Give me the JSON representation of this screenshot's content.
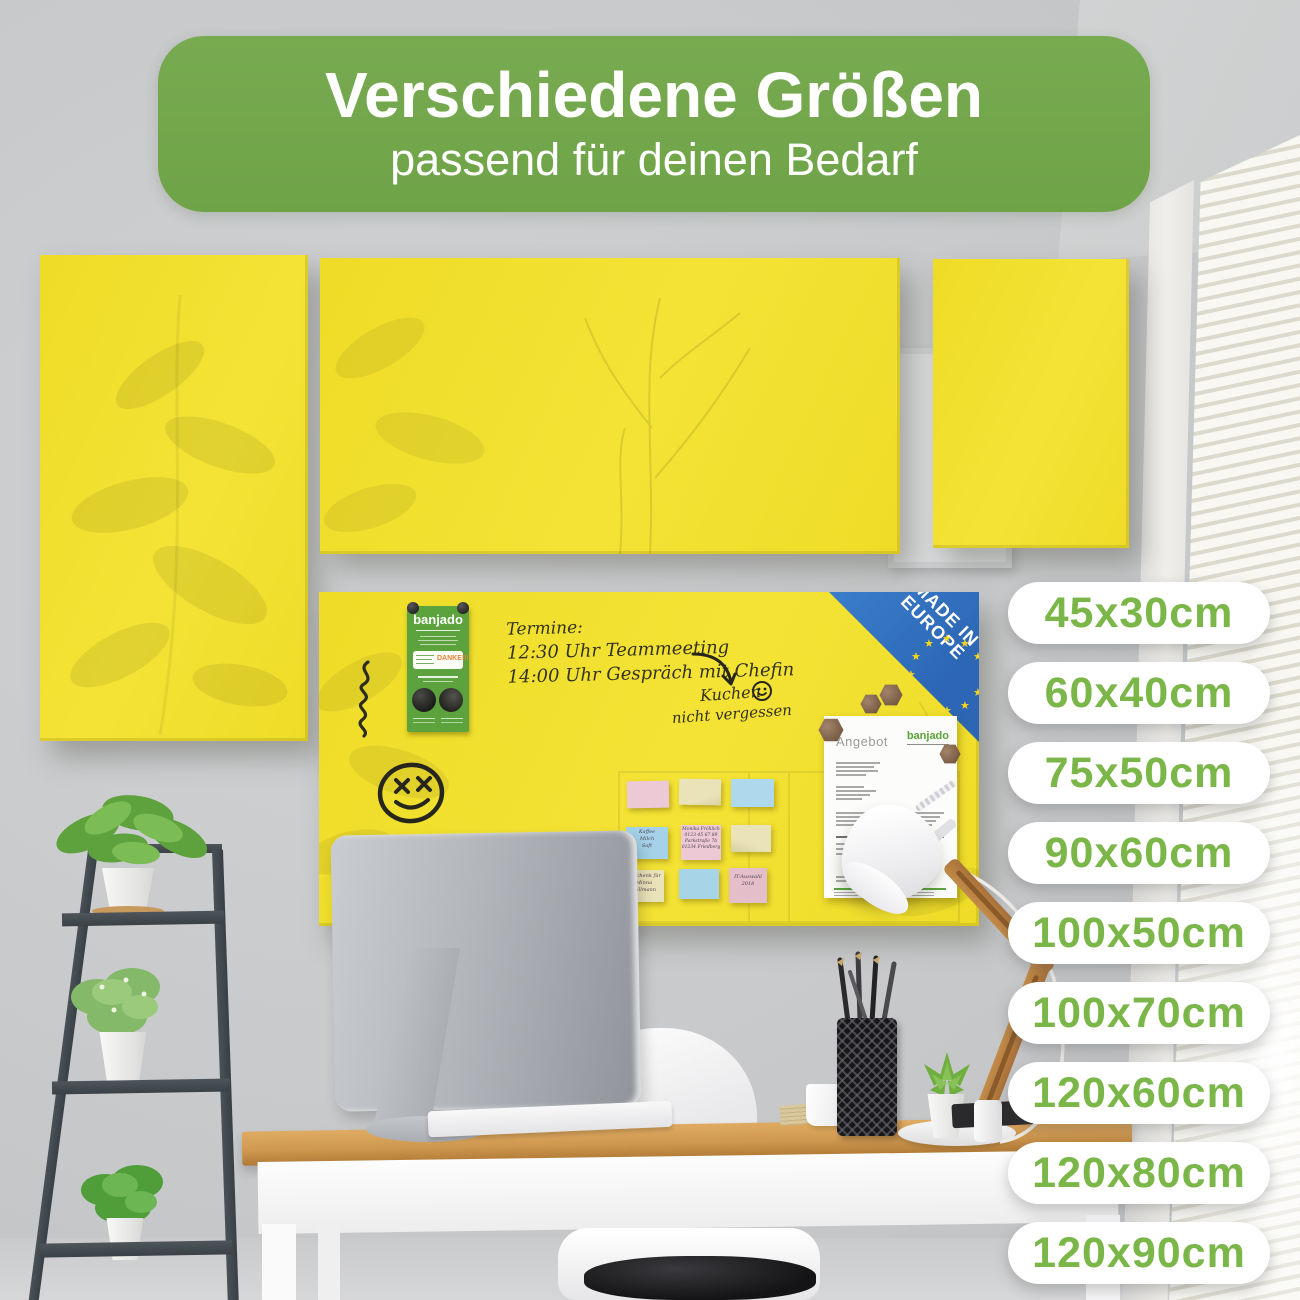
{
  "banner": {
    "title": "Verschiedene Größen",
    "subtitle": "passend für deinen Bedarf"
  },
  "sizes": [
    "45x30cm",
    "60x40cm",
    "75x50cm",
    "90x60cm",
    "100x50cm",
    "100x70cm",
    "120x60cm",
    "120x80cm",
    "120x90cm"
  ],
  "board": {
    "termine_lines": [
      "Termine:",
      "12:30 Uhr Teammeeting",
      "14:00 Uhr Gespräch mit Chefin"
    ],
    "kuchen_lines": [
      "Kuchen",
      "nicht vergessen"
    ],
    "made_in": {
      "line1": "MADE IN",
      "line2": "EUROPE"
    },
    "flyer": {
      "brand": "banjado",
      "danke": "DANKE!!!"
    },
    "document": {
      "title": "Angebot",
      "brand": "banjado"
    },
    "sticky_notes": {
      "kaffee": [
        "Kaffee",
        "Milch",
        "Saft"
      ],
      "monika": [
        "Monika Fröhlich",
        "0123 45 67 89",
        "Parkstraße 7b",
        "01234 Friedberg"
      ],
      "geschenk": [
        "Geschenk für",
        "Minna",
        "Willmann"
      ],
      "it": [
        "IT-Auswahl",
        "2018"
      ]
    }
  },
  "colors": {
    "banner_green": "#73a74d",
    "badge_text_green": "#7ab648",
    "board_yellow": "#f2e02d",
    "europe_blue": "#2f6fc2",
    "flyer_green": "#5ca33e"
  }
}
